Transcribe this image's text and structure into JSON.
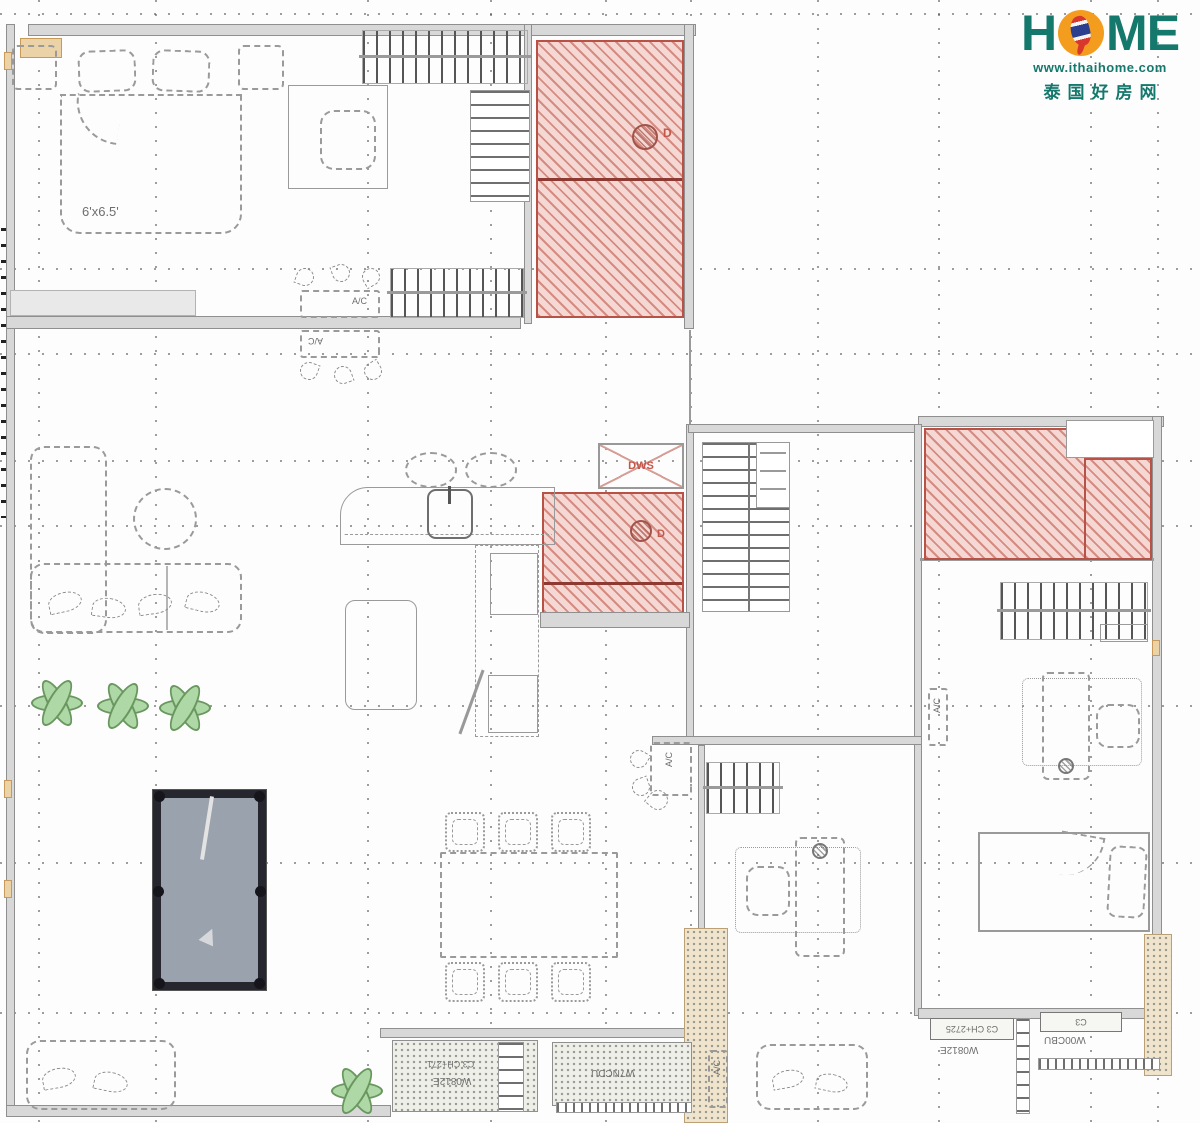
{
  "logo": {
    "h": "H",
    "me": "ME",
    "url": "www.ithaihome.com",
    "chinese": "泰国好房网",
    "teal": "#15786c",
    "orange": "#f49c1e"
  },
  "labels": {
    "bed_size": "6'x6.5'",
    "ac": "A/C",
    "dws": "DWS",
    "door_mark": "D"
  },
  "tags": {
    "window_tag_small": "C3",
    "bottom_right_tag": "C3 CH+2725",
    "bottom_right_name": "W0812E",
    "terrace_left_tag": "C3 CH+271",
    "terrace_left_name": "W0812E",
    "terrace_right_name": "W7NCDU",
    "cabinet_name": "W00CBU"
  },
  "colors": {
    "hatch_red": "#b85247",
    "hatch_fill": "#f5d8d3",
    "wall_gray": "#d8d8d8",
    "plant_green": "#aed8a6",
    "pool_felt": "#99a2ad",
    "pool_frame": "#26262e"
  }
}
